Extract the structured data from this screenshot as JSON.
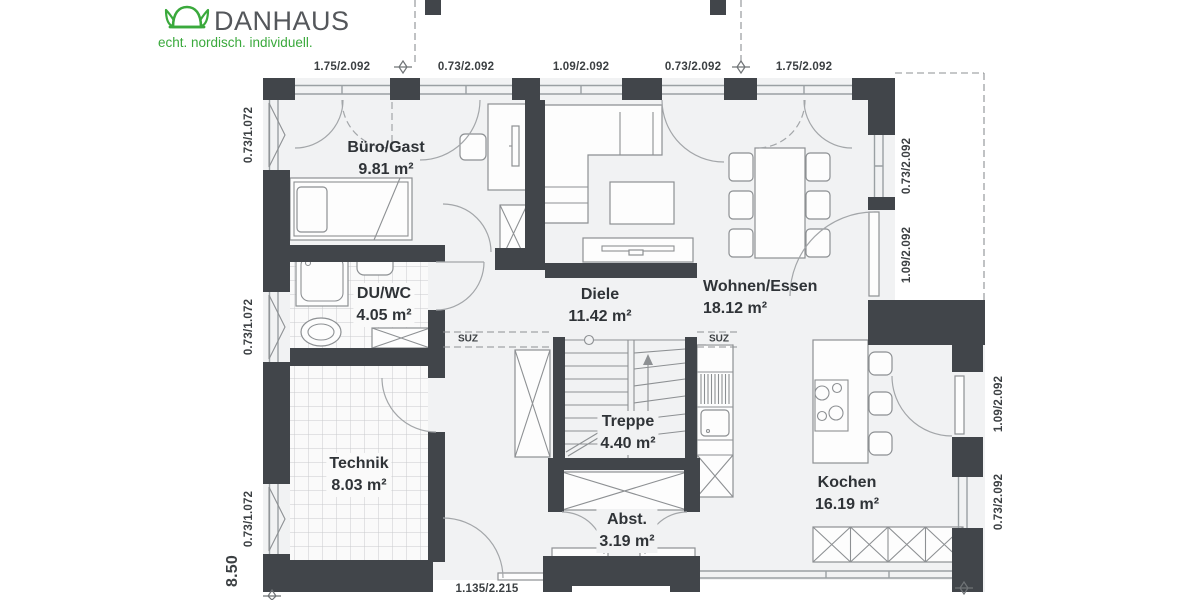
{
  "logo": {
    "brand": "DANHAUS",
    "tagline": "echt. nordisch. individuell."
  },
  "colors": {
    "wall": "#41454a",
    "floor": "#f1f2f3",
    "tile_floor": "#fafafa",
    "accent_green": "#3aa93c",
    "furniture_line": "#8d9093",
    "text": "#2f3337"
  },
  "rooms": [
    {
      "name": "Büro/Gast",
      "area": "9.81 m²"
    },
    {
      "name": "DU/WC",
      "area": "4.05 m²"
    },
    {
      "name": "Diele",
      "area": "11.42 m²"
    },
    {
      "name": "Wohnen/Essen",
      "area": "18.12 m²"
    },
    {
      "name": "Technik",
      "area": "8.03 m²"
    },
    {
      "name": "Treppe",
      "area": "4.40 m²"
    },
    {
      "name": "Abst.",
      "area": "3.19 m²"
    },
    {
      "name": "Kochen",
      "area": "16.19 m²"
    }
  ],
  "dimensions": {
    "top": [
      "1.75/2.092",
      "0.73/2.092",
      "1.09/2.092",
      "0.73/2.092",
      "1.75/2.092"
    ],
    "left": [
      "0.73/1.072",
      "0.73/1.072",
      "0.73/1.072"
    ],
    "right_upper": [
      "0.73/2.092",
      "1.09/2.092"
    ],
    "right_lower": [
      "1.09/2.092",
      "0.73/2.092"
    ],
    "bottom": "1.135/2.215",
    "overall_width": "8.50"
  },
  "annotations": {
    "suz_left": "SUZ",
    "suz_right": "SUZ"
  }
}
